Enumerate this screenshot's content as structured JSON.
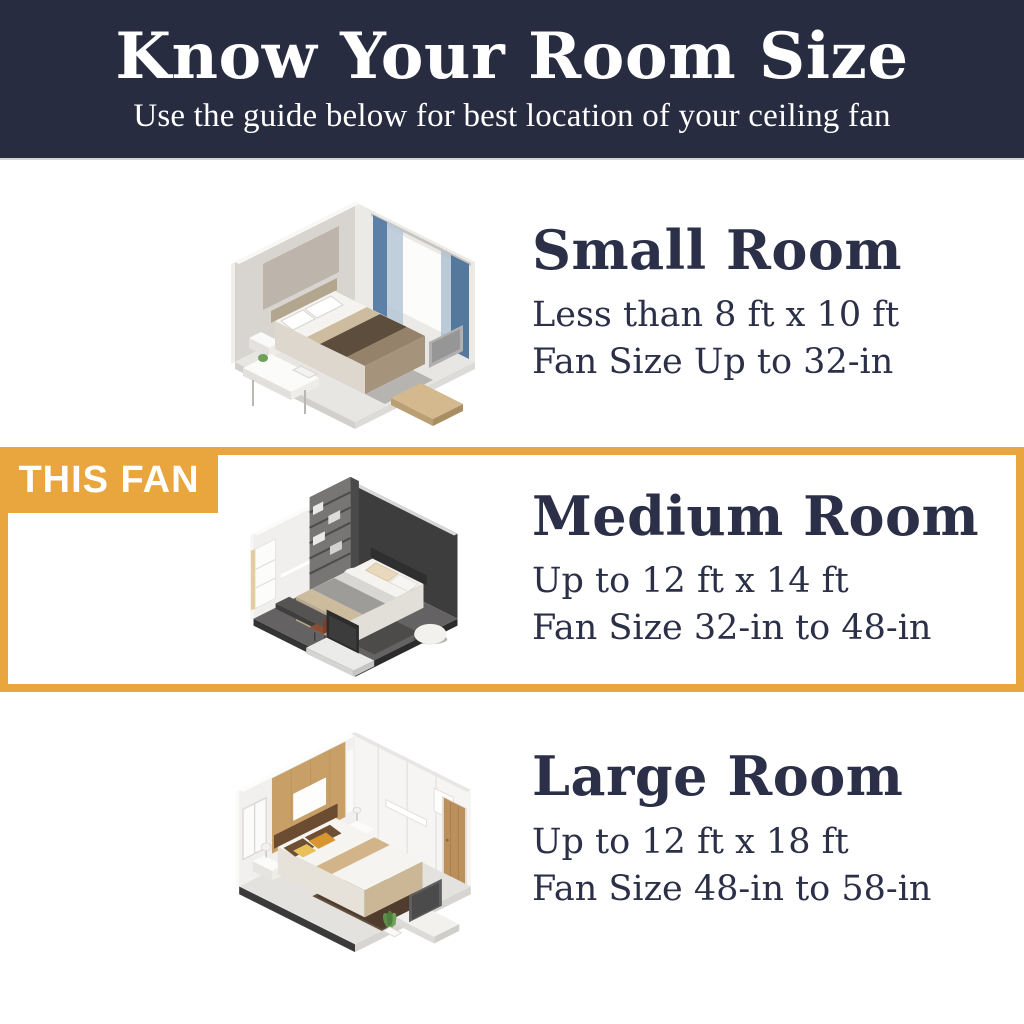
{
  "header": {
    "title": "Know Your Room Size",
    "subtitle": "Use the guide below for best location of your ceiling fan"
  },
  "highlight": {
    "badge_label": "THIS FAN"
  },
  "sections": [
    {
      "id": "small-room",
      "title": "Small Room",
      "line1": "Less than 8 ft x 10 ft",
      "line2": "Fan Size Up to 32-in",
      "illustration": "small-bedroom-isometric",
      "highlighted": false
    },
    {
      "id": "medium-room",
      "title": "Medium Room",
      "line1": "Up to 12 ft x 14 ft",
      "line2": "Fan Size 32-in to 48-in",
      "illustration": "medium-bedroom-isometric",
      "highlighted": true
    },
    {
      "id": "large-room",
      "title": "Large Room",
      "line1": "Up to 12 ft x 18 ft",
      "line2": "Fan Size 48-in to 58-in",
      "illustration": "large-bedroom-isometric",
      "highlighted": false
    }
  ],
  "colors": {
    "header_bg": "#282c40",
    "text_light": "#ffffff",
    "text_navy": "#2b3048",
    "accent_orange": "#e9a53e",
    "page_bg": "#ffffff"
  }
}
